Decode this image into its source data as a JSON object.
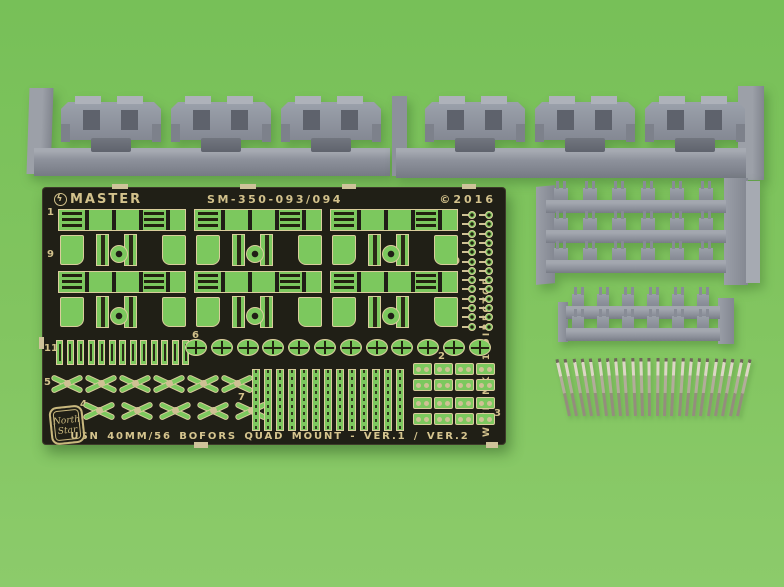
{
  "photo": {
    "background_top": "#77c058",
    "background_bottom": "#8ccb6b"
  },
  "fret": {
    "brand": "MASTER",
    "brand_icon_glyph": "ϟ",
    "part_code": "SM-350-093/094",
    "copyright": "©2016",
    "side_text": "WITH MK-51 DIRECTOR",
    "title": "USN 40MM/56 BOFORS QUAD MOUNT - VER.1 / VER.2",
    "badge_line1": "North",
    "badge_line2": "Star",
    "plate_color": "#201f16",
    "etch_color": "#d3c28c",
    "part_color": "#7cc85e",
    "labels": {
      "n1": "1",
      "n2": "2",
      "n3": "3",
      "n4": "4",
      "n5": "5",
      "n6": "6",
      "n7": "7",
      "n8": "8",
      "n9": "9",
      "n10": "10",
      "n11": "11"
    }
  },
  "castings": {
    "color": "#8e929c",
    "gun_mount_strips": 2,
    "mounts_per_strip": 3,
    "tray_bars": 3,
    "tray_parts_per_bar": 6,
    "lower_bars": 2,
    "lower_parts_per_bar": 6
  },
  "barrels": {
    "count": 24,
    "color": "#c6bfae"
  },
  "generate": {
    "racks": {
      "rows": [
        22,
        84
      ],
      "xs": [
        16,
        152,
        288
      ]
    },
    "slats": {
      "count": 13,
      "x": 14,
      "y": 153,
      "step": 10.5
    },
    "wheels": {
      "count": 12,
      "x": 143,
      "y": 152,
      "step": 25.8
    },
    "x_rows": [
      {
        "count": 6,
        "x": 8,
        "y": 184,
        "step": 34
      },
      {
        "count": 5,
        "x": 40,
        "y": 211,
        "step": 38
      }
    ],
    "strips": {
      "count": 13,
      "x": 210,
      "y": 182,
      "step": 12
    },
    "eyelets": {
      "rows": 13,
      "cols": [
        420,
        437
      ],
      "y": 24,
      "step": 9.3
    },
    "clusters": [
      {
        "x": 371,
        "y": 176,
        "rows": 2,
        "cols": 4
      },
      {
        "x": 371,
        "y": 210,
        "rows": 2,
        "cols": 4
      }
    ],
    "mount_xs": [
      31,
      141,
      251
    ],
    "tray_bar_ys": [
      22,
      52,
      82
    ],
    "low_bar_ys": [
      8,
      30
    ]
  }
}
